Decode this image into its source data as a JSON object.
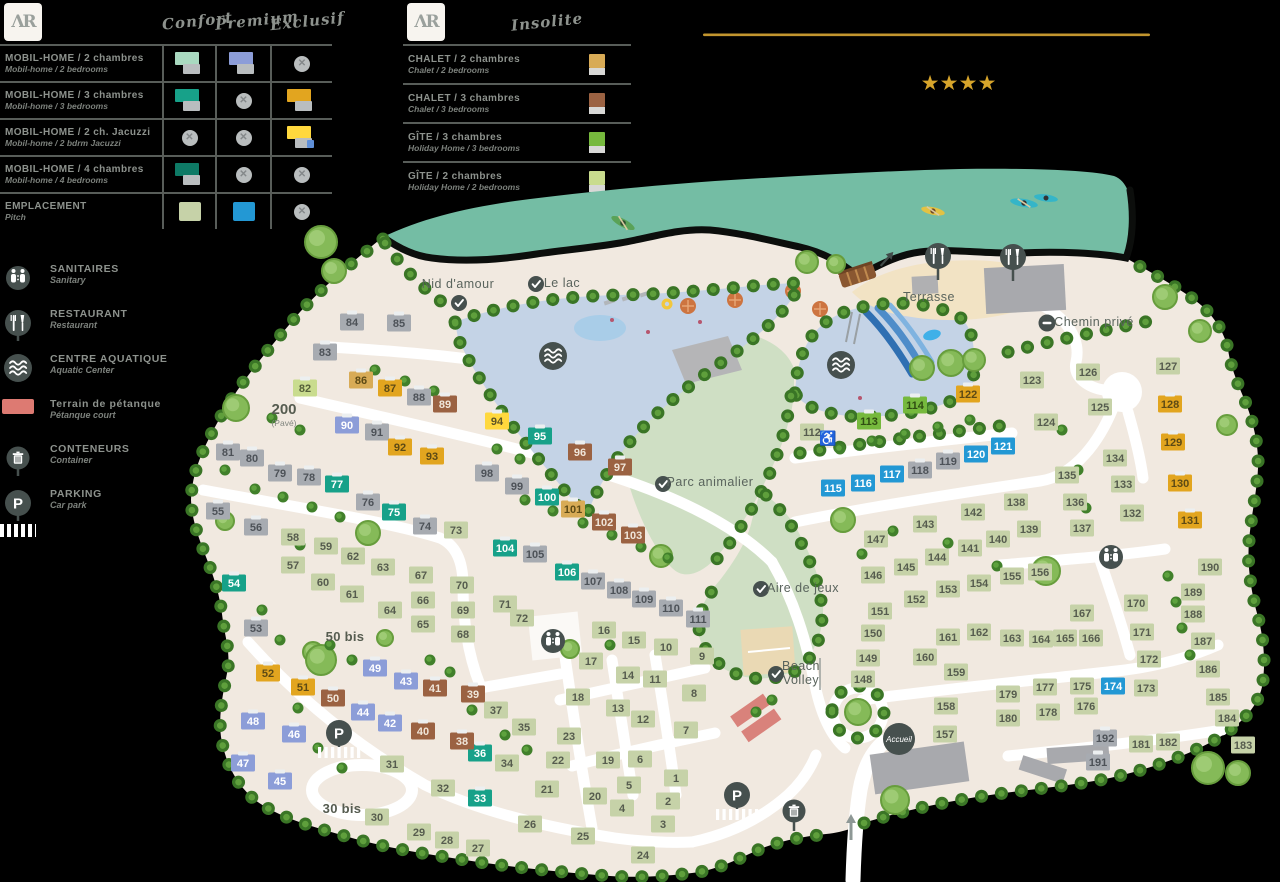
{
  "brand": {
    "monogram": "ΛR"
  },
  "rating": {
    "stars": 4,
    "star_color": "#d7a52b",
    "line_color": "#c2952e"
  },
  "legend1": {
    "columns": [
      "Confort",
      "Premium",
      "Exclusif"
    ],
    "rows": [
      {
        "fr": "MOBIL-HOME / 2 chambres",
        "en": "Mobil-home / 2 bedrooms",
        "confort": "m",
        "premium": "b",
        "exclusif": null
      },
      {
        "fr": "MOBIL-HOME / 3 chambres",
        "en": "Mobil-home / 3 bedrooms",
        "confort": "t",
        "premium": null,
        "exclusif": "o"
      },
      {
        "fr": "MOBIL-HOME / 2 ch. Jacuzzi",
        "en": "Mobil-home / 2 bdrm Jacuzzi",
        "confort": null,
        "premium": null,
        "exclusif": "j"
      },
      {
        "fr": "MOBIL-HOME / 4 chambres",
        "en": "Mobil-home / 4 bedrooms",
        "confort": "d",
        "premium": null,
        "exclusif": null
      },
      {
        "fr": "EMPLACEMENT",
        "en": "Pitch",
        "confort": "g",
        "premium": "c",
        "exclusif": null
      }
    ]
  },
  "legend2": {
    "column": "Insolite",
    "rows": [
      {
        "fr": "CHALET / 2 chambres",
        "en": "Chalet / 2 bedrooms",
        "type": "a"
      },
      {
        "fr": "CHALET / 3 chambres",
        "en": "Chalet / 3 bedrooms",
        "type": "w"
      },
      {
        "fr": "GÎTE / 3 chambres",
        "en": "Holiday Home / 3 bedrooms",
        "type": "G"
      },
      {
        "fr": "GÎTE / 2 chambres",
        "en": "Holiday Home / 2 bedrooms",
        "type": "h"
      }
    ]
  },
  "facilities": [
    {
      "fr": "SANITAIRES",
      "en": "Sanitary",
      "icon": "wc"
    },
    {
      "fr": "RESTAURANT",
      "en": "Restaurant",
      "icon": "restaurant"
    },
    {
      "fr": "CENTRE AQUATIQUE",
      "en": "Aquatic Center",
      "icon": "waves"
    },
    {
      "fr": "Terrain de pétanque",
      "en": "Pétanque court",
      "icon": "petanque"
    },
    {
      "fr": "CONTENEURS",
      "en": "Container",
      "icon": "trash"
    },
    {
      "fr": "PARKING",
      "en": "Car park",
      "icon": "parking"
    }
  ],
  "plot_types": {
    "m": {
      "label": "mobil-home-2ch-confort",
      "fill": "#a9d9c0",
      "text": "#4d5258",
      "cap": true
    },
    "b": {
      "label": "mobil-home-2ch-premium",
      "fill": "#8c9dd8",
      "text": "#ffffff",
      "cap": true
    },
    "t": {
      "label": "mobil-home-3ch-confort",
      "fill": "#17a189",
      "text": "#ffffff",
      "cap": true
    },
    "o": {
      "label": "mobil-home-3ch-exclusif",
      "fill": "#e2a51f",
      "text": "#5d4a15",
      "cap": true
    },
    "j": {
      "label": "mobil-home-2ch-jacuzzi",
      "fill": "#ffd83d",
      "text": "#5d5426",
      "cap": true
    },
    "d": {
      "label": "mobil-home-4ch-confort",
      "fill": "#0e7a66",
      "text": "#ffffff",
      "cap": true
    },
    "g": {
      "label": "emplacement-confort",
      "fill": "#c6d2a8",
      "text": "#565c4e"
    },
    "c": {
      "label": "emplacement-premium",
      "fill": "#2398d4",
      "text": "#ffffff"
    },
    "a": {
      "label": "chalet-2ch",
      "fill": "#d8ab56",
      "text": "#5d4a15",
      "cap": true
    },
    "w": {
      "label": "chalet-3ch",
      "fill": "#9b6242",
      "text": "#f0e6da",
      "cap": true
    },
    "G": {
      "label": "gite-3ch",
      "fill": "#76b93d",
      "text": "#2f4d12",
      "cap": true
    },
    "h": {
      "label": "gite-2ch",
      "fill": "#c9dc8e",
      "text": "#55603a",
      "cap": true
    },
    "y": {
      "label": "mobil-home",
      "fill": "#a7abb1",
      "text": "#4d5258",
      "cap": true
    }
  },
  "map": {
    "labels": [
      {
        "t": "Nid d'amour",
        "x": 458,
        "y": 288,
        "s": "n"
      },
      {
        "t": "Le lac",
        "x": 562,
        "y": 287,
        "s": "n"
      },
      {
        "t": "Terrasse",
        "x": 929,
        "y": 301,
        "s": "n"
      },
      {
        "t": "Chemin privé",
        "x": 1094,
        "y": 326,
        "s": "n"
      },
      {
        "t": "Parc animalier",
        "x": 710,
        "y": 486,
        "s": "n"
      },
      {
        "t": "Aire de jeux",
        "x": 803,
        "y": 592,
        "s": "n"
      },
      {
        "t": "Beach",
        "x": 801,
        "y": 670,
        "s": "n"
      },
      {
        "t": "Volley",
        "x": 801,
        "y": 684,
        "s": "n"
      },
      {
        "t": "200",
        "x": 284,
        "y": 414,
        "s": "b"
      },
      {
        "t": "(Pavé)",
        "x": 284,
        "y": 426,
        "s": "xs"
      },
      {
        "t": "50 bis",
        "x": 345,
        "y": 641,
        "s": "b2"
      },
      {
        "t": "30 bis",
        "x": 342,
        "y": 813,
        "s": "b2"
      }
    ],
    "markers": [
      {
        "i": "check",
        "x": 459,
        "y": 303
      },
      {
        "i": "check",
        "x": 536,
        "y": 284
      },
      {
        "i": "check",
        "x": 663,
        "y": 484
      },
      {
        "i": "check",
        "x": 761,
        "y": 589
      },
      {
        "i": "check",
        "x": 776,
        "y": 674
      },
      {
        "i": "noentry",
        "x": 1047,
        "y": 323
      },
      {
        "i": "waves",
        "x": 553,
        "y": 356
      },
      {
        "i": "waves",
        "x": 841,
        "y": 365
      },
      {
        "i": "restaurant",
        "x": 938,
        "y": 256
      },
      {
        "i": "restaurant",
        "x": 1013,
        "y": 257
      },
      {
        "i": "wc",
        "x": 553,
        "y": 641
      },
      {
        "i": "wc",
        "x": 1111,
        "y": 557
      },
      {
        "i": "parking",
        "x": 339,
        "y": 733
      },
      {
        "i": "parking",
        "x": 737,
        "y": 795
      },
      {
        "i": "trash",
        "x": 794,
        "y": 811
      },
      {
        "i": "accueil",
        "x": 899,
        "y": 739,
        "t": "Accueil"
      },
      {
        "i": "wheelchair",
        "x": 828,
        "y": 438
      },
      {
        "i": "arrow-up",
        "x": 851,
        "y": 828
      },
      {
        "i": "arrow-ne",
        "x": 886,
        "y": 260
      }
    ],
    "plots": [
      [
        1,
        676,
        778,
        "g"
      ],
      [
        2,
        668,
        801,
        "g"
      ],
      [
        3,
        663,
        824,
        "g"
      ],
      [
        4,
        622,
        808,
        "g"
      ],
      [
        5,
        629,
        785,
        "g"
      ],
      [
        6,
        640,
        759,
        "g"
      ],
      [
        7,
        686,
        730,
        "g"
      ],
      [
        8,
        694,
        693,
        "g"
      ],
      [
        9,
        702,
        656,
        "g"
      ],
      [
        10,
        666,
        647,
        "g"
      ],
      [
        11,
        655,
        679,
        "g"
      ],
      [
        12,
        643,
        719,
        "g"
      ],
      [
        13,
        618,
        708,
        "g"
      ],
      [
        14,
        628,
        675,
        "g"
      ],
      [
        15,
        634,
        640,
        "g"
      ],
      [
        16,
        604,
        630,
        "g"
      ],
      [
        17,
        591,
        661,
        "g"
      ],
      [
        18,
        578,
        697,
        "g"
      ],
      [
        19,
        608,
        760,
        "g"
      ],
      [
        20,
        595,
        796,
        "g"
      ],
      [
        21,
        547,
        789,
        "g"
      ],
      [
        22,
        558,
        760,
        "g"
      ],
      [
        23,
        569,
        736,
        "g"
      ],
      [
        24,
        643,
        855,
        "g"
      ],
      [
        25,
        583,
        836,
        "g"
      ],
      [
        26,
        530,
        824,
        "g"
      ],
      [
        27,
        478,
        848,
        "g"
      ],
      [
        28,
        447,
        840,
        "g"
      ],
      [
        29,
        419,
        832,
        "g"
      ],
      [
        30,
        377,
        817,
        "g"
      ],
      [
        31,
        392,
        764,
        "g"
      ],
      [
        32,
        443,
        788,
        "g"
      ],
      [
        33,
        480,
        798,
        "t"
      ],
      [
        34,
        507,
        763,
        "g"
      ],
      [
        35,
        524,
        727,
        "g"
      ],
      [
        36,
        480,
        753,
        "t"
      ],
      [
        37,
        496,
        710,
        "g"
      ],
      [
        38,
        462,
        741,
        "w"
      ],
      [
        39,
        473,
        694,
        "w"
      ],
      [
        40,
        423,
        731,
        "w"
      ],
      [
        41,
        435,
        688,
        "w"
      ],
      [
        42,
        390,
        723,
        "b"
      ],
      [
        43,
        406,
        681,
        "b"
      ],
      [
        44,
        363,
        712,
        "b"
      ],
      [
        45,
        280,
        781,
        "b"
      ],
      [
        46,
        294,
        734,
        "b"
      ],
      [
        47,
        243,
        763,
        "b"
      ],
      [
        48,
        253,
        721,
        "b"
      ],
      [
        49,
        375,
        668,
        "b"
      ],
      [
        50,
        333,
        698,
        "w"
      ],
      [
        51,
        303,
        687,
        "o"
      ],
      [
        52,
        268,
        673,
        "o"
      ],
      [
        53,
        256,
        628,
        "y"
      ],
      [
        54,
        234,
        583,
        "t"
      ],
      [
        55,
        218,
        511,
        "y"
      ],
      [
        56,
        256,
        527,
        "y"
      ],
      [
        57,
        293,
        565,
        "g"
      ],
      [
        58,
        293,
        537,
        "g"
      ],
      [
        59,
        326,
        546,
        "g"
      ],
      [
        60,
        323,
        582,
        "g"
      ],
      [
        61,
        352,
        594,
        "g"
      ],
      [
        62,
        353,
        556,
        "g"
      ],
      [
        63,
        383,
        567,
        "g"
      ],
      [
        64,
        390,
        610,
        "g"
      ],
      [
        65,
        423,
        624,
        "g"
      ],
      [
        66,
        423,
        600,
        "g"
      ],
      [
        67,
        421,
        575,
        "g"
      ],
      [
        68,
        463,
        634,
        "g"
      ],
      [
        69,
        463,
        610,
        "g"
      ],
      [
        70,
        462,
        585,
        "g"
      ],
      [
        71,
        505,
        604,
        "g"
      ],
      [
        72,
        522,
        618,
        "g"
      ],
      [
        73,
        456,
        530,
        "g"
      ],
      [
        74,
        425,
        526,
        "y"
      ],
      [
        75,
        394,
        512,
        "t"
      ],
      [
        76,
        368,
        502,
        "y"
      ],
      [
        77,
        337,
        484,
        "t"
      ],
      [
        78,
        309,
        477,
        "y"
      ],
      [
        79,
        280,
        473,
        "y"
      ],
      [
        80,
        252,
        458,
        "y"
      ],
      [
        81,
        228,
        452,
        "y"
      ],
      [
        82,
        305,
        388,
        "h"
      ],
      [
        83,
        325,
        352,
        "y"
      ],
      [
        84,
        352,
        322,
        "y"
      ],
      [
        85,
        399,
        323,
        "y"
      ],
      [
        86,
        361,
        380,
        "a"
      ],
      [
        87,
        390,
        388,
        "o"
      ],
      [
        88,
        419,
        397,
        "y"
      ],
      [
        89,
        445,
        404,
        "w"
      ],
      [
        90,
        347,
        425,
        "b"
      ],
      [
        91,
        377,
        432,
        "y"
      ],
      [
        92,
        400,
        447,
        "o"
      ],
      [
        93,
        432,
        456,
        "o"
      ],
      [
        94,
        497,
        421,
        "j"
      ],
      [
        95,
        540,
        436,
        "t"
      ],
      [
        96,
        580,
        452,
        "w"
      ],
      [
        97,
        620,
        467,
        "w"
      ],
      [
        98,
        487,
        473,
        "y"
      ],
      [
        99,
        517,
        486,
        "y"
      ],
      [
        100,
        547,
        497,
        "t"
      ],
      [
        101,
        573,
        509,
        "a"
      ],
      [
        102,
        604,
        522,
        "w"
      ],
      [
        103,
        633,
        535,
        "w"
      ],
      [
        104,
        505,
        548,
        "t"
      ],
      [
        105,
        535,
        554,
        "y"
      ],
      [
        106,
        567,
        572,
        "t"
      ],
      [
        107,
        593,
        581,
        "y"
      ],
      [
        108,
        619,
        590,
        "y"
      ],
      [
        109,
        644,
        599,
        "y"
      ],
      [
        110,
        671,
        608,
        "y"
      ],
      [
        111,
        698,
        619,
        "y"
      ],
      [
        112,
        812,
        432,
        "g"
      ],
      [
        113,
        869,
        421,
        "G"
      ],
      [
        114,
        915,
        405,
        "G"
      ],
      [
        115,
        833,
        488,
        "c"
      ],
      [
        116,
        863,
        483,
        "c"
      ],
      [
        117,
        892,
        474,
        "c"
      ],
      [
        118,
        920,
        470,
        "y"
      ],
      [
        119,
        948,
        461,
        "y"
      ],
      [
        120,
        976,
        454,
        "c"
      ],
      [
        121,
        1003,
        446,
        "c"
      ],
      [
        122,
        968,
        394,
        "o"
      ],
      [
        123,
        1032,
        380,
        "g"
      ],
      [
        124,
        1046,
        422,
        "g"
      ],
      [
        125,
        1100,
        407,
        "g"
      ],
      [
        126,
        1088,
        372,
        "g"
      ],
      [
        127,
        1168,
        366,
        "g"
      ],
      [
        128,
        1170,
        404,
        "o"
      ],
      [
        129,
        1173,
        442,
        "o"
      ],
      [
        130,
        1180,
        483,
        "o"
      ],
      [
        131,
        1190,
        520,
        "o"
      ],
      [
        132,
        1132,
        513,
        "g"
      ],
      [
        133,
        1123,
        484,
        "g"
      ],
      [
        134,
        1115,
        458,
        "g"
      ],
      [
        135,
        1067,
        475,
        "g"
      ],
      [
        136,
        1075,
        502,
        "g"
      ],
      [
        137,
        1082,
        528,
        "g"
      ],
      [
        138,
        1016,
        502,
        "g"
      ],
      [
        139,
        1029,
        529,
        "g"
      ],
      [
        140,
        998,
        539,
        "g"
      ],
      [
        141,
        970,
        548,
        "g"
      ],
      [
        142,
        973,
        512,
        "g"
      ],
      [
        143,
        925,
        524,
        "g"
      ],
      [
        144,
        937,
        557,
        "g"
      ],
      [
        145,
        906,
        567,
        "g"
      ],
      [
        146,
        873,
        575,
        "g"
      ],
      [
        147,
        876,
        539,
        "g"
      ],
      [
        148,
        863,
        679,
        "g"
      ],
      [
        149,
        868,
        658,
        "g"
      ],
      [
        150,
        873,
        633,
        "g"
      ],
      [
        151,
        880,
        611,
        "g"
      ],
      [
        152,
        916,
        599,
        "g"
      ],
      [
        153,
        948,
        589,
        "g"
      ],
      [
        154,
        979,
        583,
        "g"
      ],
      [
        155,
        1012,
        576,
        "g"
      ],
      [
        156,
        1040,
        572,
        "g"
      ],
      [
        157,
        945,
        734,
        "g"
      ],
      [
        158,
        946,
        706,
        "g"
      ],
      [
        159,
        956,
        672,
        "g"
      ],
      [
        160,
        925,
        657,
        "g"
      ],
      [
        161,
        948,
        637,
        "g"
      ],
      [
        162,
        979,
        632,
        "g"
      ],
      [
        163,
        1012,
        638,
        "g"
      ],
      [
        164,
        1041,
        639,
        "g"
      ],
      [
        165,
        1065,
        638,
        "g"
      ],
      [
        166,
        1091,
        638,
        "g"
      ],
      [
        167,
        1082,
        613,
        "g"
      ],
      [
        170,
        1136,
        603,
        "g"
      ],
      [
        171,
        1142,
        632,
        "g"
      ],
      [
        172,
        1149,
        659,
        "g"
      ],
      [
        173,
        1146,
        688,
        "g"
      ],
      [
        174,
        1113,
        686,
        "c"
      ],
      [
        175,
        1082,
        686,
        "g"
      ],
      [
        176,
        1086,
        706,
        "g"
      ],
      [
        177,
        1045,
        687,
        "g"
      ],
      [
        178,
        1048,
        712,
        "g"
      ],
      [
        179,
        1008,
        694,
        "g"
      ],
      [
        180,
        1008,
        718,
        "g"
      ],
      [
        181,
        1141,
        744,
        "g"
      ],
      [
        182,
        1168,
        742,
        "g"
      ],
      [
        183,
        1243,
        745,
        "g"
      ],
      [
        184,
        1227,
        718,
        "g"
      ],
      [
        185,
        1218,
        697,
        "g"
      ],
      [
        186,
        1208,
        669,
        "g"
      ],
      [
        187,
        1203,
        641,
        "g"
      ],
      [
        188,
        1193,
        614,
        "g"
      ],
      [
        189,
        1193,
        592,
        "g"
      ],
      [
        190,
        1210,
        567,
        "g"
      ],
      [
        191,
        1098,
        762,
        "y"
      ],
      [
        192,
        1105,
        738,
        "y"
      ]
    ]
  }
}
